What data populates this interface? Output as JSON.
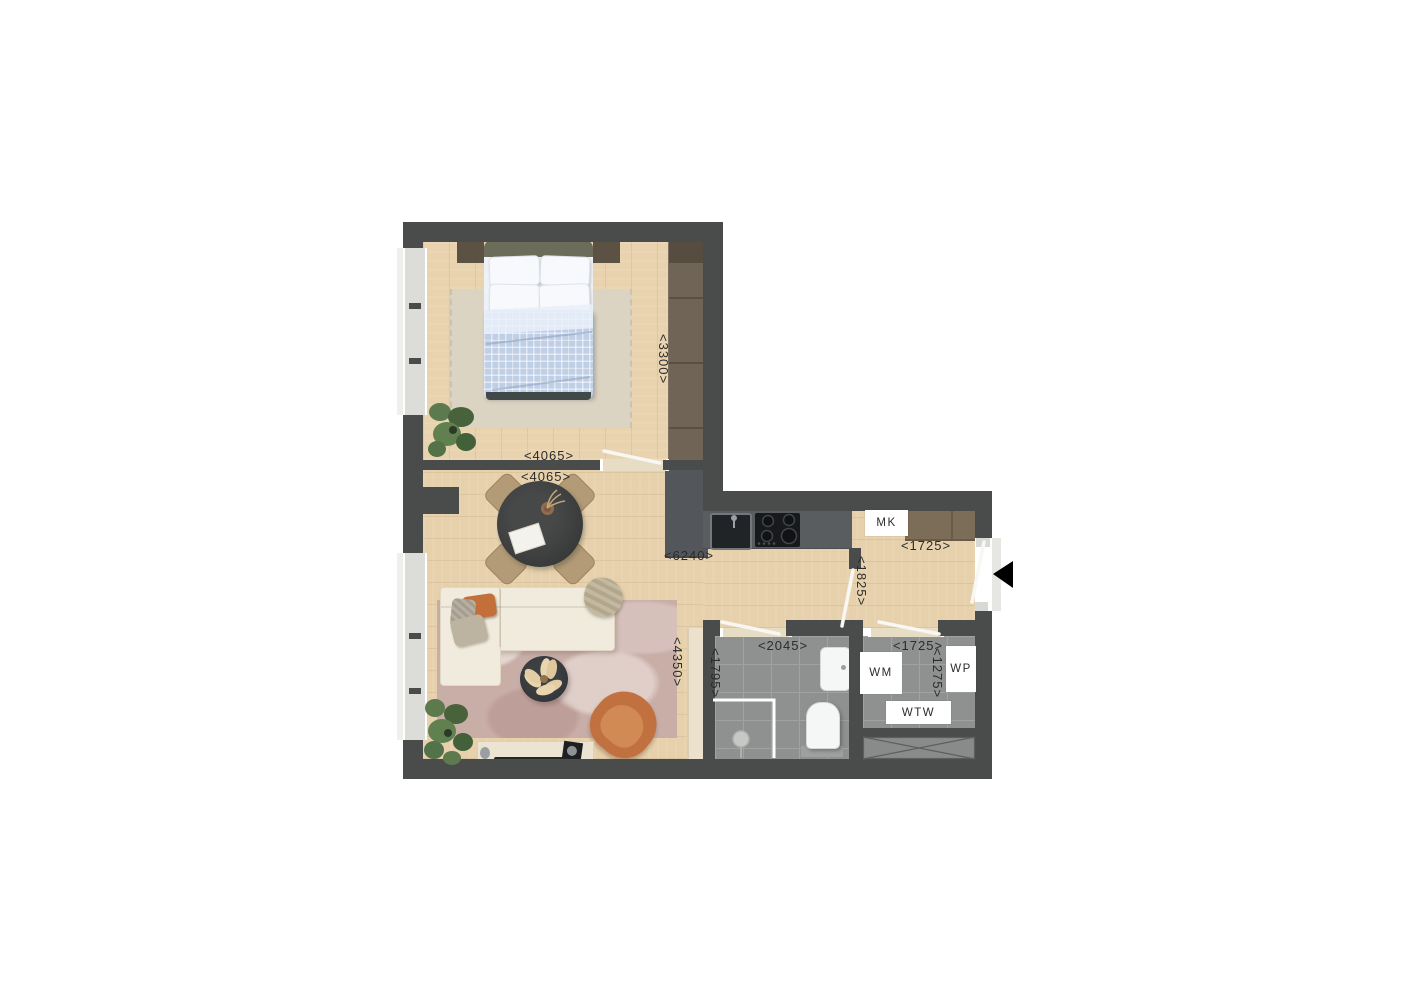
{
  "title": "apartment-floor-plan",
  "rooms": {
    "bedroom": {
      "width_label": "<4065>",
      "height_label": "<3300>"
    },
    "living": {
      "width_label": "<4065>",
      "height_label": "<4350>"
    },
    "kitchen": {
      "width_label": "<6240>"
    },
    "hall": {
      "width_label": "<1725>",
      "height_label": "<1825>"
    },
    "bathroom": {
      "width_label": "<2045>",
      "height_label": "<1795>"
    },
    "tech_room": {
      "width_label": "<1725>",
      "height_label": "<1275>"
    }
  },
  "fixtures": {
    "meter_cupboard": "MK",
    "washing_machine": "WM",
    "heat_pump": "WP",
    "heat_recovery": "WTW"
  },
  "colors": {
    "wall": "#4a4c4b",
    "wood_floor": "#e8d3b0",
    "tile_floor": "#8f9191",
    "window": "#dcdcd9",
    "accent_orange": "#c4763f",
    "label_text": "#2b2c2c"
  }
}
